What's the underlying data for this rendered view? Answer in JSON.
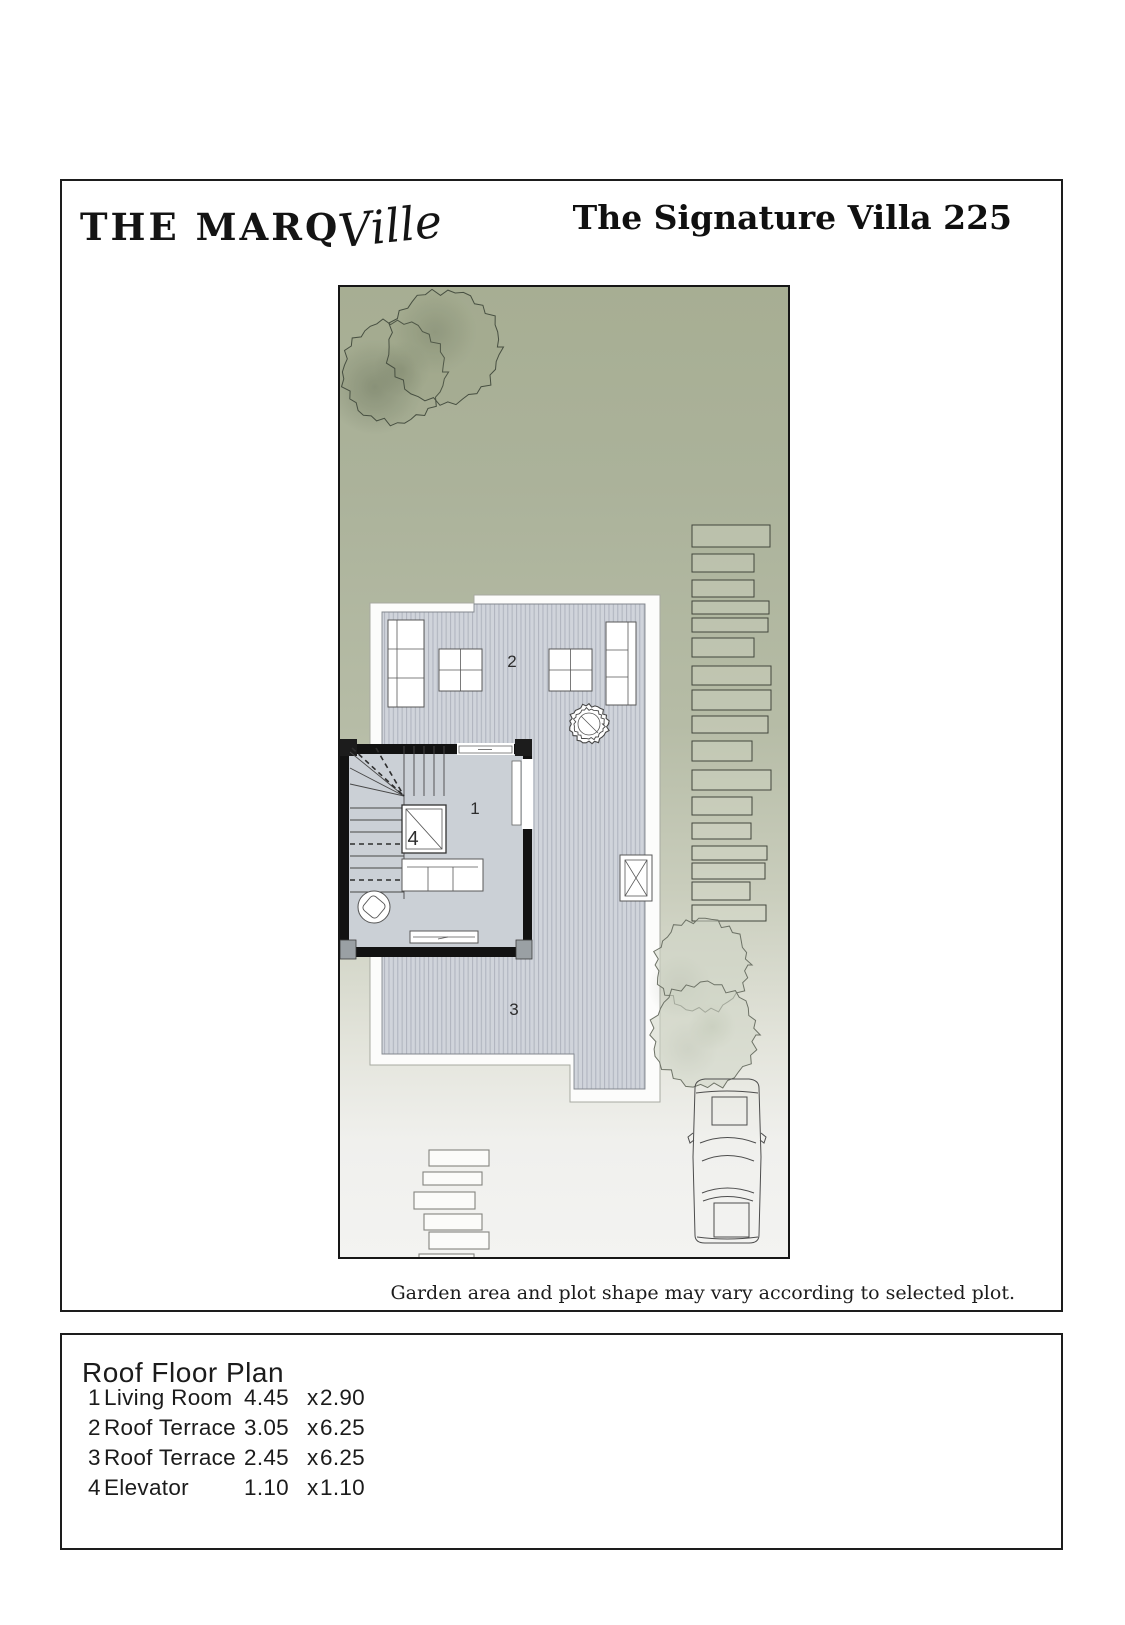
{
  "header": {
    "logo_main": "THE MARQ",
    "logo_script": "Ville",
    "title": "The Signature Villa 225"
  },
  "plan": {
    "note": "Garden area and plot shape may vary according to selected plot.",
    "labels": {
      "living_room": "1",
      "roof_terrace_upper": "2",
      "roof_terrace_lower": "3",
      "elevator": "4"
    }
  },
  "legend": {
    "title": "Roof Floor Plan",
    "rooms": [
      {
        "num": "1",
        "name": "Living Room",
        "dim_a": "4.45",
        "sep": "x",
        "dim_b": "2.90"
      },
      {
        "num": "2",
        "name": "Roof Terrace",
        "dim_a": "3.05",
        "sep": "x",
        "dim_b": "6.25"
      },
      {
        "num": "3",
        "name": "Roof Terrace",
        "dim_a": "2.45",
        "sep": "x",
        "dim_b": "6.25"
      },
      {
        "num": "4",
        "name": "Elevator",
        "dim_a": "1.10",
        "sep": "x",
        "dim_b": "1.10"
      }
    ]
  },
  "colors": {
    "garden_green": "#abb29a",
    "deck_gray": "#d0d4db",
    "line_black": "#161616"
  }
}
